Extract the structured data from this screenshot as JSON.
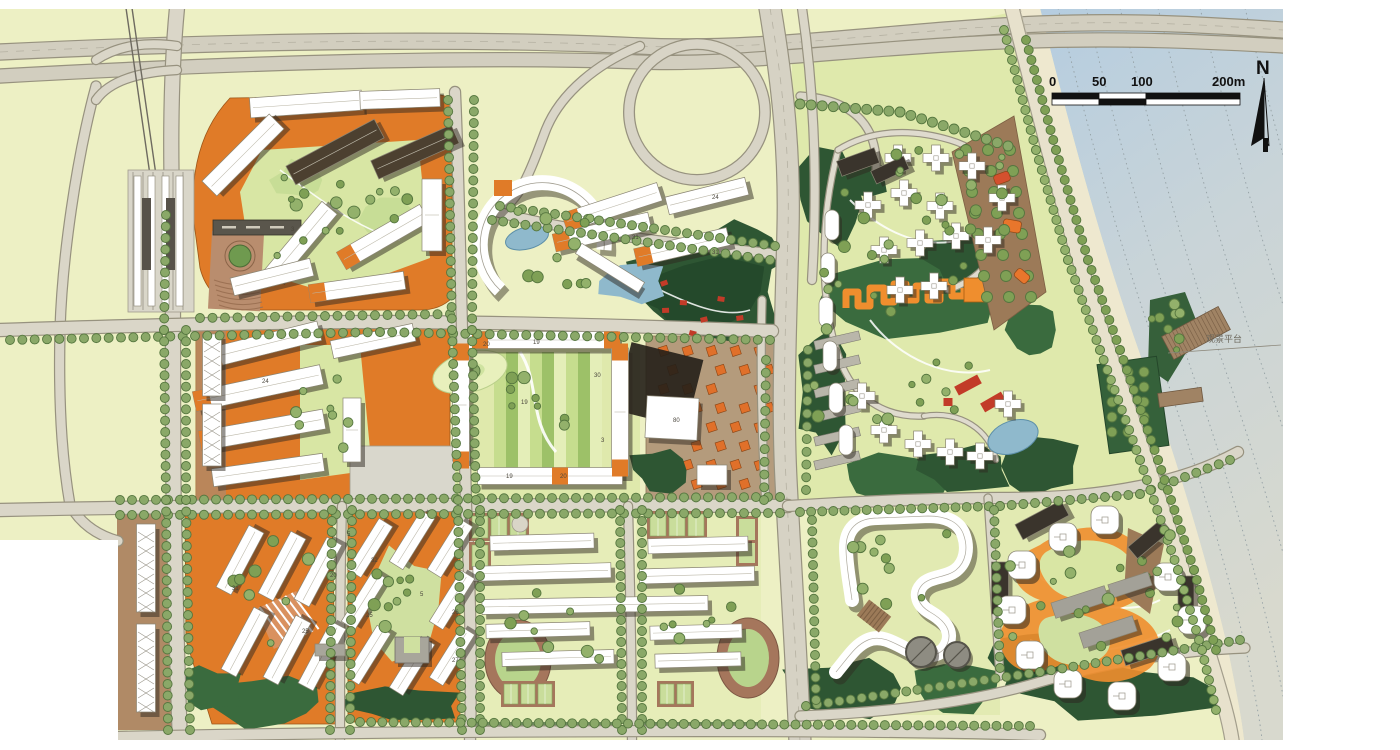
{
  "map": {
    "type": "urban-masterplan-site-plan",
    "north_label": "N",
    "scale_bar": {
      "ticks": [
        "0",
        "50",
        "100",
        "200m"
      ],
      "unit": "m"
    },
    "annotations": [
      {
        "text": "观景平台",
        "x": 1226,
        "y": 341
      }
    ],
    "building_numbers": [
      {
        "label": "31",
        "x": 632,
        "y": 239
      },
      {
        "label": "31",
        "x": 712,
        "y": 254
      },
      {
        "label": "24",
        "x": 712,
        "y": 199
      },
      {
        "label": "24",
        "x": 262,
        "y": 383
      },
      {
        "label": "20",
        "x": 483,
        "y": 346
      },
      {
        "label": "19",
        "x": 533,
        "y": 344
      },
      {
        "label": "30",
        "x": 594,
        "y": 377
      },
      {
        "label": "19",
        "x": 521,
        "y": 404
      },
      {
        "label": "3",
        "x": 601,
        "y": 442
      },
      {
        "label": "19",
        "x": 506,
        "y": 478
      },
      {
        "label": "20",
        "x": 560,
        "y": 478
      },
      {
        "label": "80",
        "x": 673,
        "y": 422
      },
      {
        "label": "3",
        "x": 291,
        "y": 231
      },
      {
        "label": "5",
        "x": 347,
        "y": 536
      },
      {
        "label": "32",
        "x": 371,
        "y": 562
      },
      {
        "label": "25",
        "x": 366,
        "y": 617
      },
      {
        "label": "26",
        "x": 452,
        "y": 614
      },
      {
        "label": "27",
        "x": 452,
        "y": 662
      },
      {
        "label": "31",
        "x": 232,
        "y": 590
      },
      {
        "label": "25",
        "x": 302,
        "y": 633
      },
      {
        "label": "20",
        "x": 330,
        "y": 577
      },
      {
        "label": "5",
        "x": 420,
        "y": 596
      }
    ],
    "colors": {
      "land_base": "#edf0c4",
      "park_green": "#dfe9ac",
      "lawn_light": "#d8e6a4",
      "forest_dark": "#2e5633",
      "tree_green": "#8aa868",
      "road_fill": "#dad6c8",
      "road_casing": "#97927f",
      "orange_ground": "#e07b28",
      "orange_accent": "#ef8e2e",
      "building_white": "#ffffff",
      "shadow_dark": "#2e2820",
      "water_top": "#b5cde0",
      "water_bottom": "#d8d9ce",
      "sand": "#eee7d0",
      "track_brown": "#a5765c",
      "court_green": "#c9dd9b",
      "plaza_brown": "#b98d6e",
      "red_pavilion": "#c23b28"
    }
  }
}
